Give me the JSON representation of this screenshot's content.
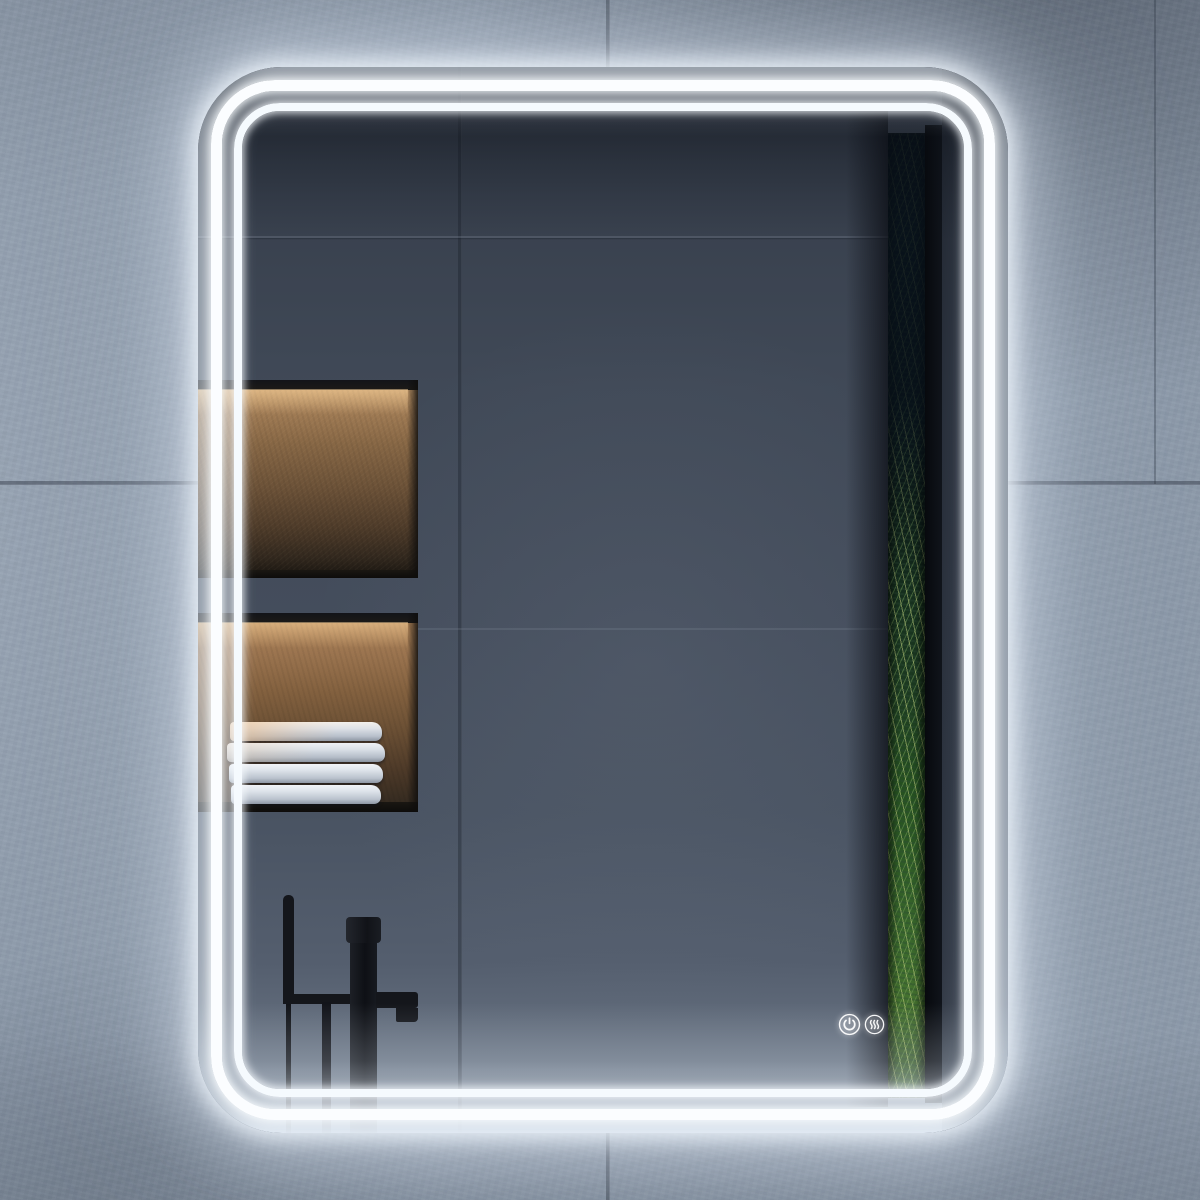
{
  "image": {
    "kind": "product-photo",
    "subject": "Rounded-corner LED bathroom mirror with double LED light band, lit",
    "setting": "concrete tiled bathroom wall"
  },
  "wall": {
    "tile_color": "#8d9aaa",
    "grout_color": "#2c3440",
    "tile_joints": [
      "vertical",
      "horizontal"
    ]
  },
  "mirror": {
    "shape": "rounded-rectangle",
    "orientation": "portrait",
    "led_band_count": 2,
    "led_color": "#ffffff",
    "glow_color": "#e6eefa",
    "touch_controls": [
      {
        "name": "power",
        "icon": "power-icon"
      },
      {
        "name": "defogger",
        "icon": "defogger-icon"
      }
    ]
  },
  "reflection": {
    "wall_color": "#424b59",
    "upper_niche": {
      "light": "warm",
      "items": [
        "stone-bowl",
        "dried-flower"
      ],
      "back_color": "#876745"
    },
    "lower_niche": {
      "light": "warm",
      "items": [
        "towel-stack"
      ],
      "towel_count": 4,
      "towel_color": "#dce2e9"
    },
    "fixtures": [
      "freestanding-black-tub-faucet",
      "hand-shower"
    ],
    "fixture_color": "#14161b",
    "window": {
      "view": "forest-trees",
      "colors": [
        "#0e1e26",
        "#1c3a20",
        "#45722f"
      ]
    }
  }
}
